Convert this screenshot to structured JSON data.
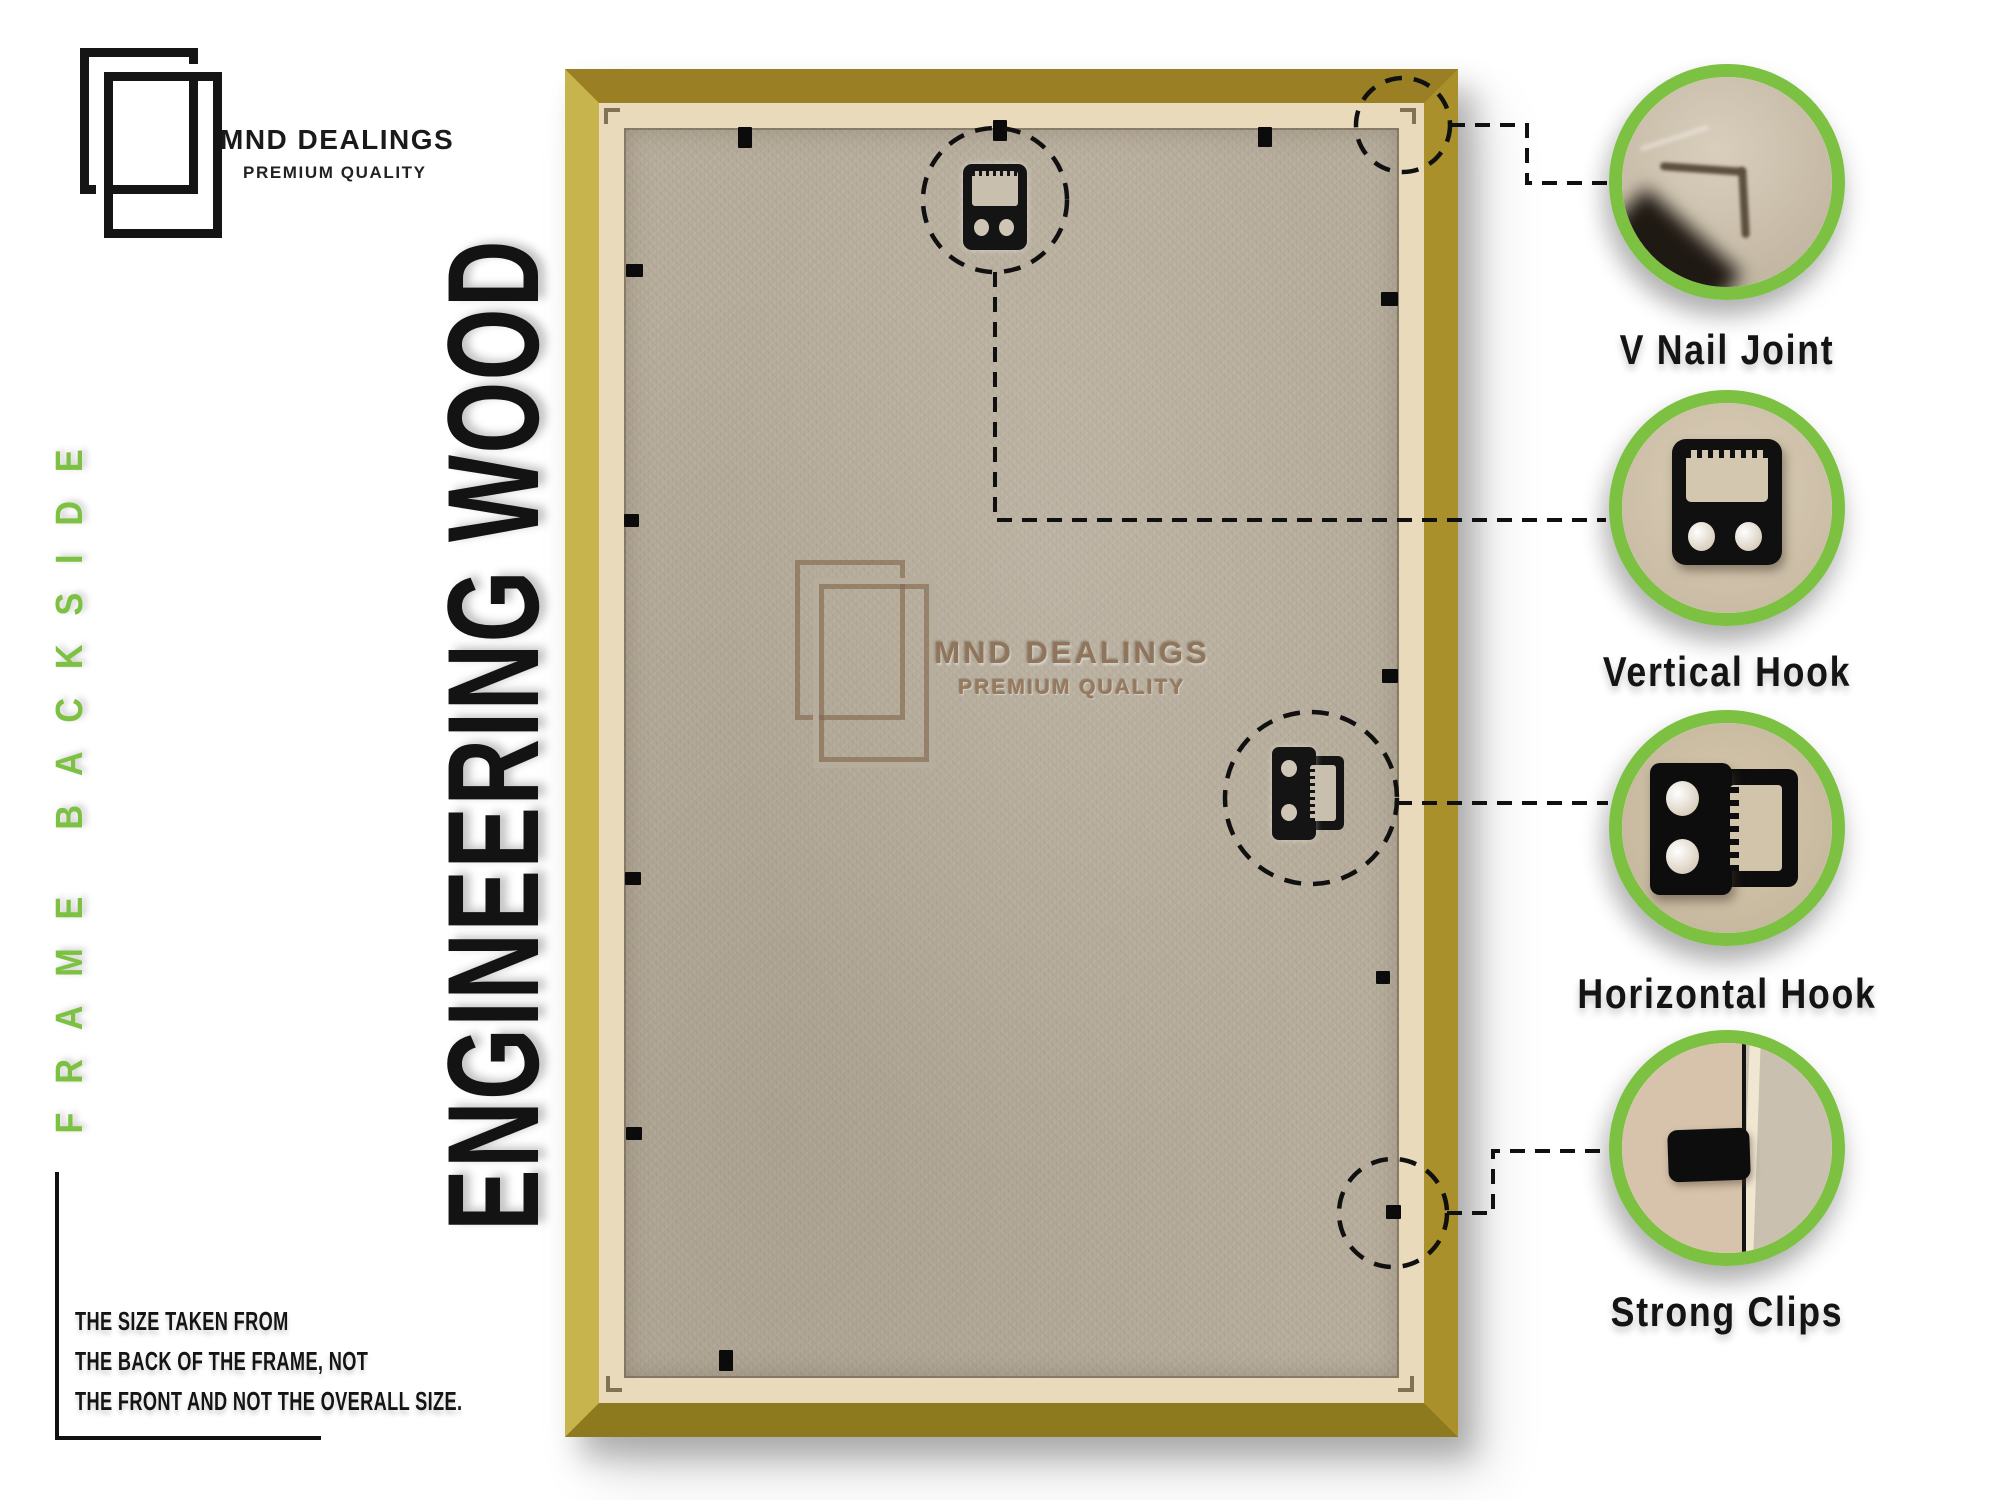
{
  "brand": {
    "name": "MND DEALINGS",
    "tagline": "PREMIUM QUALITY",
    "logo_icon": "double-frame-logo"
  },
  "side_label": "FRAME BACKSIDE",
  "material_label": "ENGINEERING WOOD",
  "watermark": {
    "name": "MND DEALINGS",
    "tagline": "PREMIUM QUALITY"
  },
  "callouts": [
    {
      "label": "V Nail Joint",
      "icon": "v-nail-corner-photo"
    },
    {
      "label": "Vertical Hook",
      "icon": "vertical-hook-photo"
    },
    {
      "label": "Horizontal Hook",
      "icon": "horizontal-hook-photo"
    },
    {
      "label": "Strong Clips",
      "icon": "strong-clip-photo"
    }
  ],
  "footnote": {
    "lines": [
      "THE SIZE TAKEN FROM",
      "THE BACK OF THE FRAME, NOT",
      "THE FRONT AND NOT THE OVERALL SIZE."
    ]
  },
  "colors": {
    "accent_green": "#7cc142",
    "gold_light": "#c8b44c",
    "gold_dark": "#8e7a1e",
    "lip": "#e9dabb",
    "board": "#b7ad9c",
    "ink": "#151515"
  }
}
